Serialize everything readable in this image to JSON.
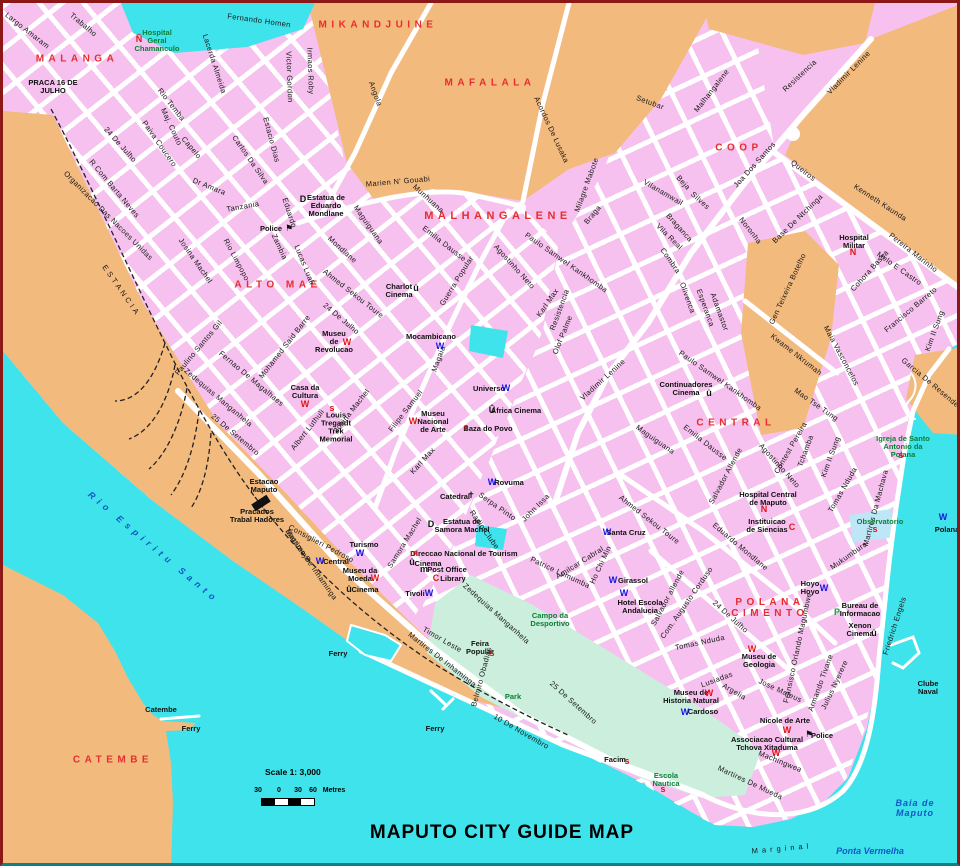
{
  "title": "MAPUTO CITY GUIDE MAP",
  "scale": {
    "label": "Scale 1: 3,000",
    "ticks": [
      "30",
      "0",
      "30",
      "60"
    ],
    "unit": "Metres"
  },
  "colors": {
    "water": "#3FE3EB",
    "land": "#F3BA7E",
    "city": "#F6C1EE",
    "campo": "#CBEEDD",
    "pond": "#BDE7F6",
    "road": "#FFFFFF",
    "district": "#E62E2E",
    "green": "#0B7F35",
    "water_text": "#1456C8",
    "rail": "#222222"
  },
  "map": {
    "districts": [
      [
        "MALANGA",
        74,
        56,
        10
      ],
      [
        "MIKANDJUINE",
        375,
        22,
        10
      ],
      [
        "MAFALALA",
        487,
        80,
        10
      ],
      [
        "MALHANGALENE",
        495,
        213,
        11
      ],
      [
        "ALTO MAE",
        275,
        282,
        10
      ],
      [
        "COOP",
        736,
        145,
        10
      ],
      [
        "CENTRAL",
        733,
        420,
        10
      ],
      [
        "POLANA\nCIMENTO",
        767,
        605,
        10
      ],
      [
        "CATEMBE",
        110,
        757,
        10
      ]
    ],
    "water_labels": [
      [
        "Rio Espiritu Santo",
        150,
        545,
        40,
        5
      ],
      [
        "Baia de\nMaputo",
        912,
        806,
        0,
        1
      ],
      [
        "Ponta Vermelha",
        867,
        849,
        0,
        0
      ]
    ],
    "streets": [
      [
        "Largo Amaram",
        24,
        28,
        38
      ],
      [
        "Trabalho",
        80,
        22,
        40
      ],
      [
        "Fernando Homen",
        256,
        18,
        8
      ],
      [
        "Lacerda Almeida",
        211,
        61,
        72
      ],
      [
        "Victor Gordon",
        286,
        74,
        88
      ],
      [
        "Irmaos Roby",
        307,
        68,
        88
      ],
      [
        "Rio Temba",
        168,
        102,
        52
      ],
      [
        "Maj. Couto",
        168,
        124,
        65
      ],
      [
        "Paiva Coucero",
        156,
        141,
        55
      ],
      [
        "Capelo",
        188,
        145,
        50
      ],
      [
        "Carlos Da Silva",
        247,
        157,
        55
      ],
      [
        "Estacio Dias",
        268,
        137,
        75
      ],
      [
        "24 De Julho",
        117,
        142,
        48
      ],
      [
        "Angola",
        372,
        91,
        70
      ],
      [
        "Acordos De Lusaka",
        548,
        127,
        65
      ],
      [
        "Setubar",
        647,
        100,
        20
      ],
      [
        "Malhangalene",
        709,
        88,
        -52
      ],
      [
        "Resistencia",
        797,
        73,
        -43
      ],
      [
        "Vladimir Lenine",
        846,
        70,
        -45
      ],
      [
        "Joa Dos Santos",
        752,
        162,
        -48
      ],
      [
        "Queiros",
        800,
        168,
        38
      ],
      [
        "Kenneth Kaunda",
        877,
        200,
        33
      ],
      [
        "Beja",
        680,
        180,
        48
      ],
      [
        "Silves",
        697,
        198,
        42
      ],
      [
        "Vilanamwail",
        660,
        190,
        30
      ],
      [
        "Braganca",
        676,
        225,
        48
      ],
      [
        "Vila Real",
        666,
        234,
        45
      ],
      [
        "Combra",
        667,
        258,
        55
      ],
      [
        "Noronha",
        747,
        228,
        52
      ],
      [
        "Base De Ntchinga",
        795,
        216,
        -44
      ],
      [
        "Olivenca",
        684,
        295,
        70
      ],
      [
        "Esperanca",
        702,
        305,
        70
      ],
      [
        "Adamastor",
        716,
        309,
        70
      ],
      [
        "Gen Teixeira Botelho",
        785,
        286,
        -65
      ],
      [
        "Cohora Bassa",
        867,
        268,
        -48
      ],
      [
        "Pereira Marinho",
        910,
        250,
        38
      ],
      [
        "Melo E Castro",
        896,
        266,
        35
      ],
      [
        "Francisco Barreto",
        908,
        307,
        -40
      ],
      [
        "Kim Il Sung",
        932,
        328,
        -70
      ],
      [
        "Kim Il Sung",
        828,
        454,
        -70
      ],
      [
        "Kwame Nkrumah",
        793,
        352,
        38
      ],
      [
        "Maia Vasconcelos",
        838,
        353,
        62
      ],
      [
        "Garcia De Resende",
        927,
        380,
        40
      ],
      [
        "Mao Tse Tung",
        813,
        402,
        35
      ],
      [
        "Contest Pereira",
        788,
        445,
        -60
      ],
      [
        "Tchamba",
        803,
        448,
        -70
      ],
      [
        "Agostinho Neto",
        776,
        463,
        48
      ],
      [
        "Salvador Allende",
        723,
        473,
        -62
      ],
      [
        "Salvador allende",
        665,
        595,
        -62
      ],
      [
        "Eduardo Mondlane",
        737,
        544,
        40
      ],
      [
        "Com. Augusto Corduso",
        684,
        600,
        -55
      ],
      [
        "24 De Julho",
        727,
        614,
        42
      ],
      [
        "Tomas Nduda",
        697,
        640,
        -12
      ],
      [
        "Tomas Nduda",
        840,
        487,
        -60
      ],
      [
        "Martires Da Machava",
        873,
        505,
        -75
      ],
      [
        "Mukumbura",
        846,
        553,
        -35
      ],
      [
        "Friedrich Engels",
        892,
        623,
        -72
      ],
      [
        "Fransisco Orlando Magumbwe",
        795,
        645,
        -78
      ],
      [
        "Armando Tivane",
        818,
        680,
        -70
      ],
      [
        "Jose Mateus",
        777,
        688,
        25
      ],
      [
        "Julius Nyerere",
        832,
        682,
        -65
      ],
      [
        "Lusiadas",
        714,
        677,
        -20
      ],
      [
        "Argelia",
        731,
        689,
        30
      ],
      [
        "Machingwea",
        777,
        759,
        22
      ],
      [
        "Martires De Mueda",
        747,
        780,
        25
      ],
      [
        "Martires De Inhaminga",
        439,
        657,
        38
      ],
      [
        "Timor Leste",
        439,
        637,
        30
      ],
      [
        "Belmiro Obadias",
        479,
        674,
        -75
      ],
      [
        "Zedequias Manganhela",
        493,
        611,
        42
      ],
      [
        "25 De Setembro",
        570,
        700,
        42
      ],
      [
        "10 De Novembro",
        518,
        729,
        30
      ],
      [
        "25 De Setembro",
        232,
        432,
        40
      ],
      [
        "Zedequias Manganhela",
        215,
        395,
        40
      ],
      [
        "Fernao De Magalhaes",
        248,
        376,
        40
      ],
      [
        "Mohamed Said Barre",
        282,
        344,
        -52
      ],
      [
        "Albert Luthuli",
        305,
        427,
        -52
      ],
      [
        "Josina Machel",
        349,
        408,
        -52
      ],
      [
        "Samora Machel",
        402,
        540,
        -58
      ],
      [
        "Consiglieri Pedroso",
        318,
        541,
        28
      ],
      [
        "Bagamoyo",
        295,
        543,
        55
      ],
      [
        "Martires De Inhaminga",
        308,
        562,
        55
      ],
      [
        "Paulino Santos Gil",
        196,
        345,
        -50
      ],
      [
        "Josina Machel",
        192,
        258,
        55
      ],
      [
        "Rio Limpopo",
        233,
        257,
        62
      ],
      [
        "Zambia",
        276,
        244,
        65
      ],
      [
        "Lucas Luali",
        301,
        262,
        68
      ],
      [
        "Eduardo",
        286,
        210,
        72
      ],
      [
        "Mondlane",
        339,
        247,
        42
      ],
      [
        "Maguiguana",
        365,
        222,
        55
      ],
      [
        "Maguiguana",
        652,
        437,
        35
      ],
      [
        "Ahmed Sekou Toure",
        350,
        291,
        38
      ],
      [
        "Ahmed Sekou Toure",
        646,
        517,
        38
      ],
      [
        "24 De Julho",
        338,
        316,
        40
      ],
      [
        "Amilcar Cabral",
        577,
        560,
        -32
      ],
      [
        "Ho Chi Min",
        598,
        562,
        -65
      ],
      [
        "Patrice Lumumba",
        557,
        570,
        25
      ],
      [
        "John Issa",
        533,
        505,
        -45
      ],
      [
        "Serpa Pinto",
        494,
        504,
        35
      ],
      [
        "Radio Clube",
        481,
        527,
        55
      ],
      [
        "Karl Max",
        420,
        458,
        -48
      ],
      [
        "Karl Max",
        545,
        300,
        -55
      ],
      [
        "Filipe Samuel",
        403,
        408,
        -52
      ],
      [
        "Magaia",
        436,
        356,
        -70
      ],
      [
        "Guerra Popular",
        454,
        278,
        -58
      ],
      [
        "Agostinho Neto",
        511,
        264,
        48
      ],
      [
        "Paulo Samwel Kankhomba",
        563,
        260,
        35
      ],
      [
        "Paulo Samwel Kankhomba",
        717,
        378,
        35
      ],
      [
        "Emilia Dausse",
        441,
        241,
        38
      ],
      [
        "Emilia Dausse",
        702,
        440,
        38
      ],
      [
        "Munhuana",
        425,
        196,
        42
      ],
      [
        "Marien N' Gouabi",
        395,
        179,
        -5
      ],
      [
        "Dr Amara",
        206,
        184,
        22
      ],
      [
        "Tanzania",
        240,
        204,
        -10
      ],
      [
        "Organizacao Das Nacoes Unidas",
        105,
        213,
        45
      ],
      [
        "R Com Barta Neves",
        111,
        186,
        50
      ],
      [
        "Olof Palme",
        560,
        332,
        -68
      ],
      [
        "Vladimir Lenine",
        600,
        377,
        -42
      ],
      [
        "Resistencia",
        557,
        307,
        -70
      ],
      [
        "Braga",
        590,
        212,
        -50
      ],
      [
        "Milagre Mabote",
        584,
        182,
        -70
      ],
      [
        "ESTANCIA",
        118,
        288,
        55,
        3
      ],
      [
        "Marginal",
        779,
        846,
        -5,
        4
      ]
    ],
    "places": [
      [
        "PRACA 16 DE\nJULHO",
        50,
        84,
        0
      ],
      [
        "Hospital\nGeral\nChamanculo",
        154,
        38,
        1
      ],
      [
        "Estatua de\nEduardo\nMondlane",
        323,
        203,
        0
      ],
      [
        "Police",
        268,
        226,
        0
      ],
      [
        "Museu\nde\nRevolucao",
        331,
        339,
        0
      ],
      [
        "Charlot\nCinema",
        396,
        288,
        0
      ],
      [
        "Mocambicano",
        428,
        334,
        0
      ],
      [
        "Museu\nNacional\nde Arte",
        430,
        419,
        0
      ],
      [
        "Universo",
        486,
        386,
        0
      ],
      [
        "Africa Cinema",
        513,
        408,
        0
      ],
      [
        "Baza do Povo",
        485,
        426,
        0
      ],
      [
        "Louis\nTregardt\nTrek\nMemorial",
        333,
        424,
        0
      ],
      [
        "Casa da\nCultura",
        302,
        389,
        0
      ],
      [
        "Catedral",
        452,
        494,
        0
      ],
      [
        "Rovuma",
        506,
        480,
        0
      ],
      [
        "Estatua de\nSamora Machel",
        459,
        523,
        0
      ],
      [
        "Turismo",
        361,
        542,
        0
      ],
      [
        "Central",
        333,
        559,
        0
      ],
      [
        "Direccao Nacional de Tourism",
        461,
        551,
        0
      ],
      [
        "Cinema",
        425,
        561,
        0
      ],
      [
        "Post Office",
        444,
        567,
        0
      ],
      [
        "Library",
        450,
        576,
        0
      ],
      [
        "Tivoli",
        412,
        591,
        0
      ],
      [
        "Museu da\nMoeda",
        357,
        572,
        0
      ],
      [
        "Cinema",
        362,
        587,
        0
      ],
      [
        "Santa Cruz",
        623,
        530,
        0
      ],
      [
        "Girassol",
        630,
        578,
        0
      ],
      [
        "Hotel Escola\nAndalucia",
        637,
        604,
        0
      ],
      [
        "Hospital Central\nde Maputo",
        765,
        496,
        0
      ],
      [
        "Instituicao\nde Siencias",
        764,
        523,
        0
      ],
      [
        "Hoyo\nHoyo",
        807,
        585,
        0
      ],
      [
        "Xenon\nCinema",
        857,
        627,
        0
      ],
      [
        "Museu de\nGeologia",
        756,
        658,
        0
      ],
      [
        "Museu de\nHistoria Natural",
        688,
        694,
        0
      ],
      [
        "Cardoso",
        700,
        709,
        0
      ],
      [
        "Nicole de Arte",
        782,
        718,
        0
      ],
      [
        "Police",
        819,
        733,
        0
      ],
      [
        "Associacao Cultural\nTchova Xitaduma",
        764,
        741,
        0
      ],
      [
        "Estacao\nMaputo",
        261,
        483,
        0
      ],
      [
        "Pracados\nTrabal Hadores",
        254,
        513,
        0
      ],
      [
        "Feira\nPopular",
        477,
        645,
        0
      ],
      [
        "Facim",
        612,
        757,
        0
      ],
      [
        "Clube\nNaval",
        925,
        685,
        0
      ],
      [
        "Hospital\nMilitar",
        851,
        239,
        0
      ],
      [
        "Continuadores\nCinema",
        683,
        386,
        0
      ],
      [
        "Polana",
        944,
        527,
        0
      ],
      [
        "Ferry",
        335,
        651,
        0
      ],
      [
        "Ferry",
        432,
        726,
        0
      ],
      [
        "Ferry",
        188,
        726,
        0
      ],
      [
        "Catembe",
        158,
        707,
        0
      ],
      [
        "Bureau de\nInformacao",
        857,
        607,
        0
      ],
      [
        "Campo da\nDesportivo",
        547,
        617,
        1
      ],
      [
        "Park",
        510,
        694,
        1
      ],
      [
        "Observatorio",
        877,
        519,
        1
      ],
      [
        "Igreja de Santo\nAntonio da Polana",
        900,
        444,
        1
      ],
      [
        "Escola\nNautica",
        663,
        777,
        1
      ]
    ],
    "icons": [
      [
        "W",
        437,
        344,
        "b"
      ],
      [
        "W",
        503,
        386,
        "b"
      ],
      [
        "W",
        489,
        480,
        "b"
      ],
      [
        "W",
        357,
        551,
        "b"
      ],
      [
        "W",
        317,
        559,
        "b"
      ],
      [
        "W",
        426,
        591,
        "b"
      ],
      [
        "W",
        604,
        530,
        "b"
      ],
      [
        "W",
        610,
        578,
        "b"
      ],
      [
        "W",
        621,
        591,
        "b"
      ],
      [
        "W",
        821,
        586,
        "b"
      ],
      [
        "W",
        682,
        710,
        "b"
      ],
      [
        "W",
        940,
        515,
        "b"
      ],
      [
        "W",
        344,
        340,
        "r"
      ],
      [
        "W",
        410,
        419,
        "r"
      ],
      [
        "W",
        302,
        402,
        "r"
      ],
      [
        "W",
        372,
        576,
        "r"
      ],
      [
        "W",
        749,
        647,
        "r"
      ],
      [
        "W",
        706,
        691,
        "r"
      ],
      [
        "W",
        784,
        728,
        "r"
      ],
      [
        "W",
        773,
        751,
        "r"
      ],
      [
        "û",
        413,
        286,
        "k"
      ],
      [
        "Û",
        489,
        408,
        "k"
      ],
      [
        "û",
        409,
        560,
        "k"
      ],
      [
        "û",
        346,
        587,
        "k"
      ],
      [
        "û",
        871,
        631,
        "k"
      ],
      [
        "û",
        706,
        391,
        "k"
      ],
      [
        "m",
        411,
        551,
        "r"
      ],
      [
        "m",
        421,
        567,
        "k"
      ],
      [
        "C",
        433,
        576,
        "r"
      ],
      [
        "C",
        789,
        525,
        "r"
      ],
      [
        "N",
        761,
        507,
        "r"
      ],
      [
        "N",
        850,
        250,
        "r"
      ],
      [
        "Ñ",
        136,
        37,
        "r"
      ],
      [
        "s",
        463,
        425,
        "r"
      ],
      [
        "s",
        329,
        406,
        "r"
      ],
      [
        "s",
        872,
        527,
        "r"
      ],
      [
        "s",
        898,
        453,
        "r"
      ],
      [
        "s",
        660,
        787,
        "r"
      ],
      [
        "s",
        624,
        759,
        "r"
      ],
      [
        "s",
        489,
        651,
        "r"
      ],
      [
        "D",
        300,
        197,
        "k"
      ],
      [
        "D",
        428,
        522,
        "k"
      ],
      [
        "P",
        834,
        610,
        "g"
      ],
      [
        "⚑",
        286,
        226,
        "k"
      ],
      [
        "⚑",
        806,
        732,
        "k"
      ],
      [
        "✝",
        468,
        493,
        "k"
      ]
    ]
  }
}
